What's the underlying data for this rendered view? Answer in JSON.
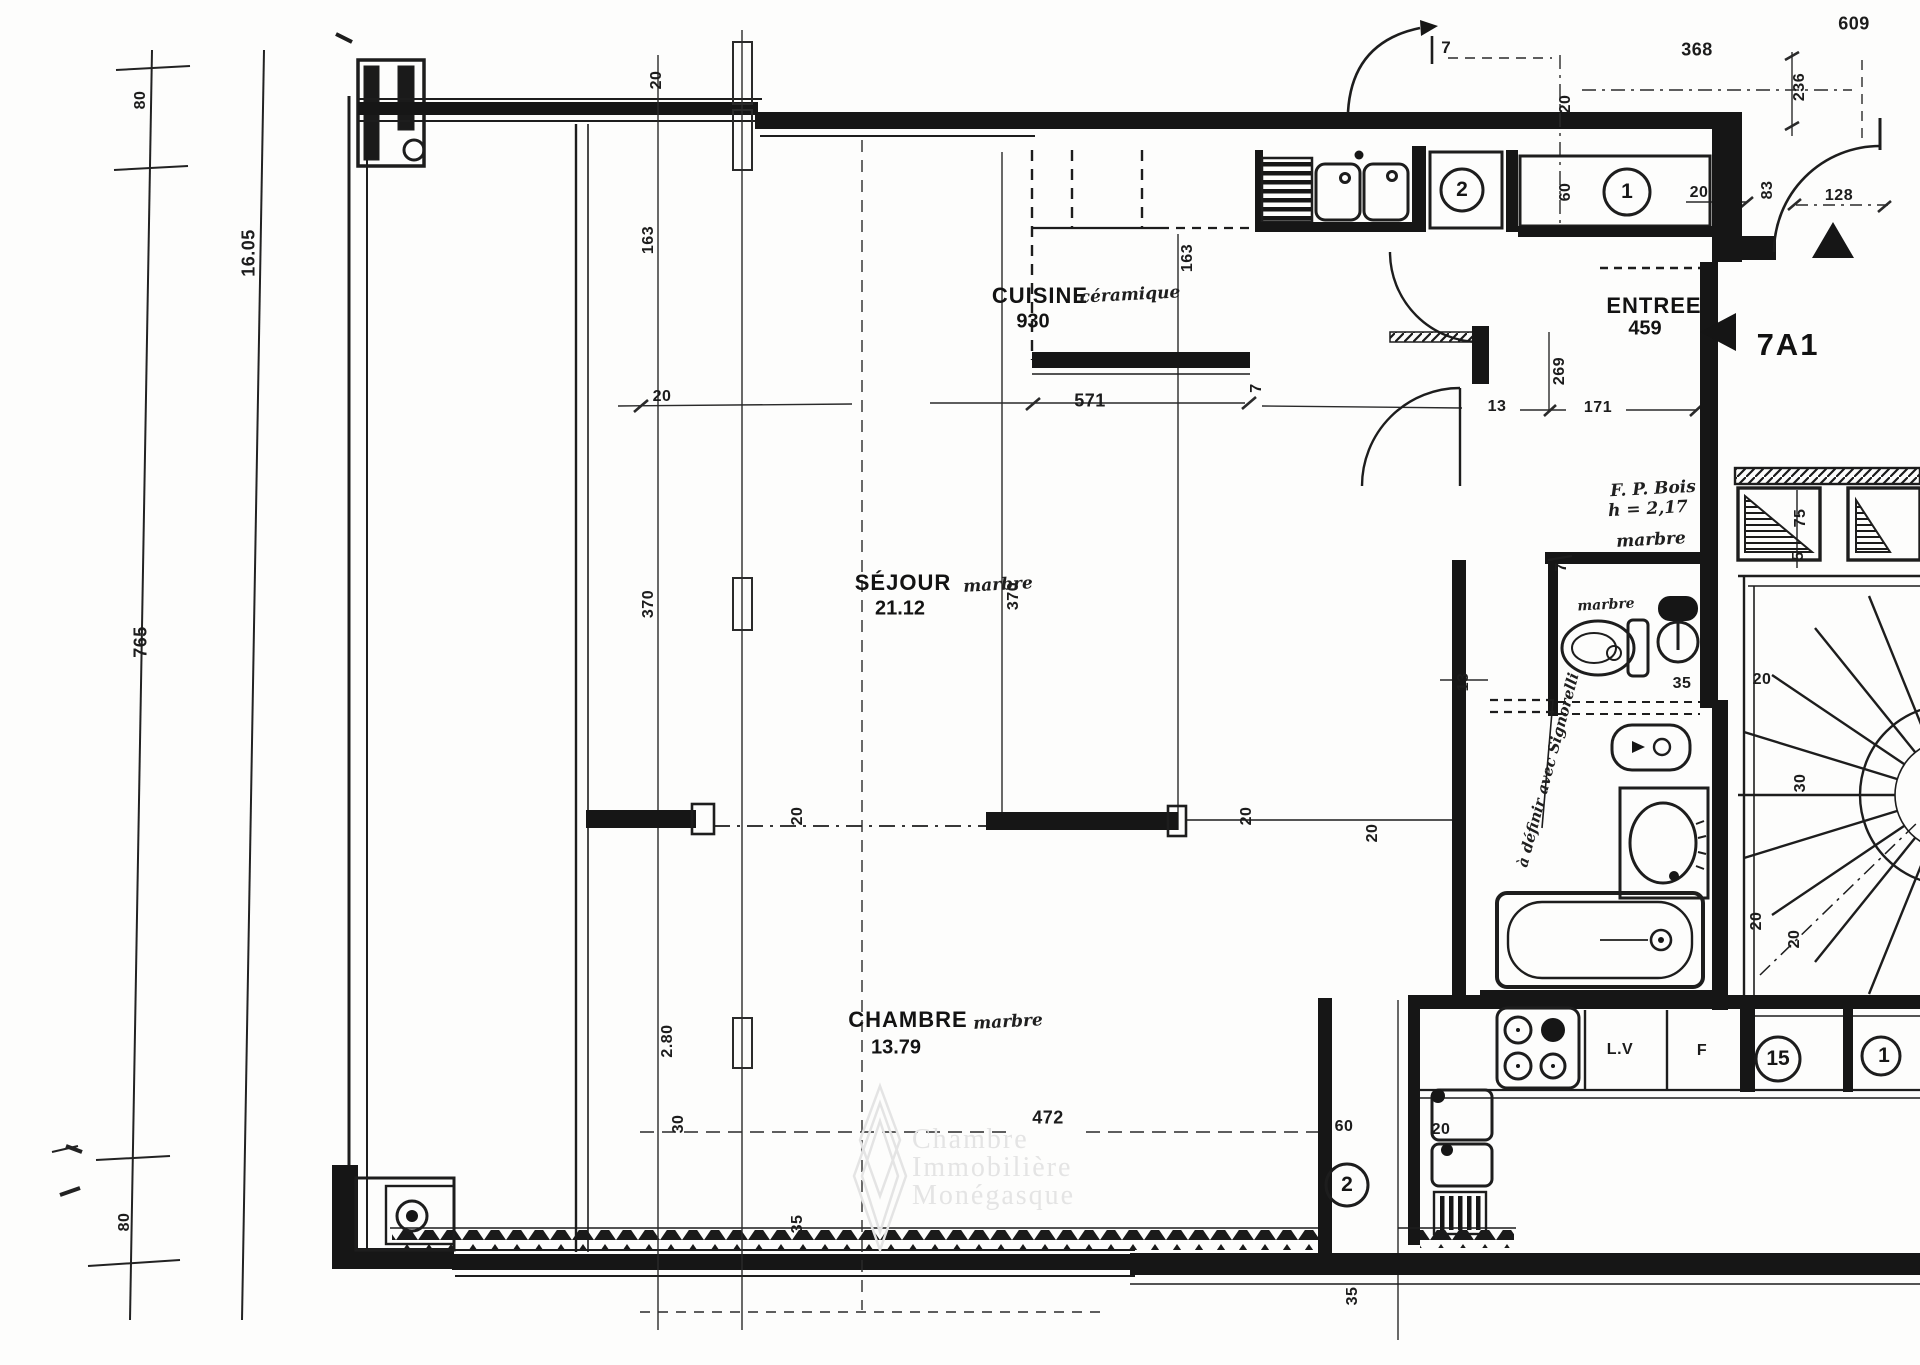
{
  "meta": {
    "unit_label": "7A1",
    "unit_arrow_icon": "left-filled-arrow",
    "north_arrow_icon": "filled-triangle-up",
    "watermark_lines": [
      "Chambre",
      "Immobilière",
      "Monégasque"
    ]
  },
  "rooms": {
    "cuisine": {
      "name": "CUISINE",
      "finish": "céramique",
      "area": "930"
    },
    "sejour": {
      "name": "SÉJOUR",
      "finish": "marbre",
      "area": "21.12"
    },
    "chambre": {
      "name": "CHAMBRE",
      "finish": "marbre",
      "area": "13.79"
    },
    "entree": {
      "name": "ENTREE",
      "area": "459"
    }
  },
  "annotations": {
    "fp_bois_line1": "F. P. Bois",
    "fp_bois_line2": "h = 2,17",
    "fp_bois_line3": "marbre",
    "wc_finish": "marbre",
    "handwritten_note": "à définir avec Signorelli",
    "door_label_top": "7"
  },
  "appliances": {
    "dishwasher_label": "L.V",
    "fridge_label": "F"
  },
  "circled": {
    "kitchen_counter": "2",
    "entry_counter": "1",
    "appliance_big": "15",
    "appliance_edge": "1",
    "annex": "2"
  },
  "dims": [
    "80",
    "16.05",
    "765",
    "80",
    "20",
    "163",
    "163",
    "20",
    "368",
    "236",
    "609",
    "60",
    "20",
    "83",
    "128",
    "20",
    "571",
    "7",
    "13",
    "171",
    "269",
    "370",
    "370",
    "13",
    "7",
    "35",
    "75",
    "5",
    "20",
    "30",
    "20",
    "20",
    "20",
    "20",
    "20",
    "2.80",
    "30",
    "472",
    "35",
    "60",
    "20",
    "35"
  ]
}
